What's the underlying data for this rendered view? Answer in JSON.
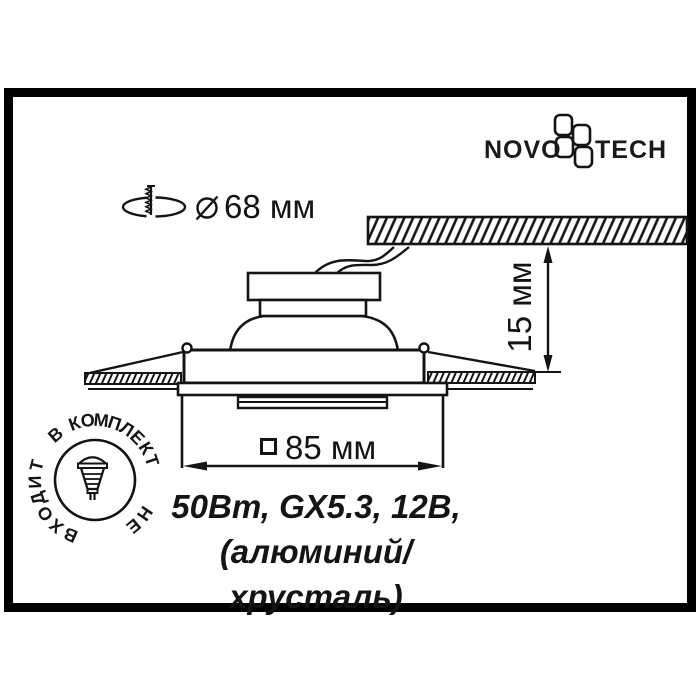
{
  "brand": {
    "name_left": "NOVO",
    "name_right": "TECH",
    "logo_icon": "novotech-flower"
  },
  "annotations": {
    "cutout": {
      "symbol": "⌀",
      "value": "68 мм",
      "icon": "ceiling-hole-drill-icon"
    },
    "depth": {
      "value": "15 мм"
    },
    "width": {
      "symbol": "□",
      "value": "85 мм"
    }
  },
  "specs": {
    "line1": "50Вт, GX5.3, 12В,",
    "line2": "(алюминий/хрусталь)"
  },
  "stamp": {
    "text": "В КОМПЛЕКТ НЕ ВХОДИТ",
    "lamp_icon": "mr16-lamp-icon"
  },
  "colors": {
    "ink": "#141414",
    "frame": "#000000",
    "background": "#ffffff"
  }
}
